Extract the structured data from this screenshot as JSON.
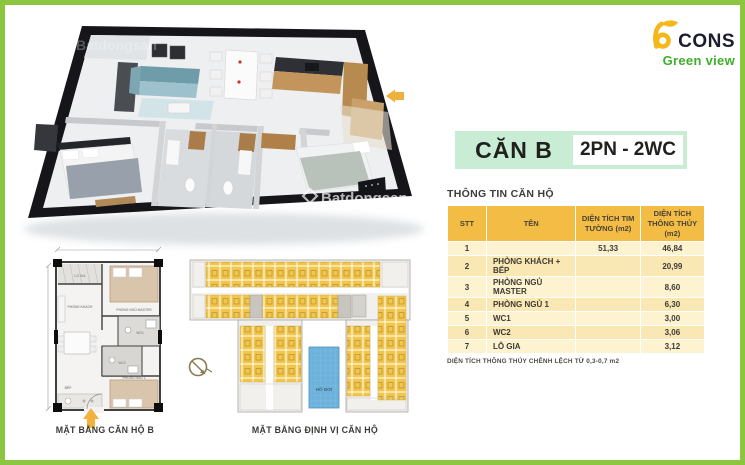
{
  "brand": {
    "name": "CONS",
    "subtitle": "Green view",
    "icon": "bcons-b-icon"
  },
  "unit_badge": {
    "name": "CĂN B",
    "config": "2PN - 2WC"
  },
  "info_table": {
    "title": "THÔNG TIN CĂN HỘ",
    "columns": [
      "STT",
      "TÊN",
      "DIỆN TÍCH TIM TƯỜNG (m2)",
      "DIỆN TÍCH THÔNG THỦY (m2)"
    ],
    "rows": [
      {
        "stt": "1",
        "ten": "",
        "tim_tuong": "51,33",
        "thong_thuy": "46,84"
      },
      {
        "stt": "2",
        "ten": "PHÒNG KHÁCH + BẾP",
        "tim_tuong": "",
        "thong_thuy": "20,99"
      },
      {
        "stt": "3",
        "ten": "PHÒNG NGỦ MASTER",
        "tim_tuong": "",
        "thong_thuy": "8,60"
      },
      {
        "stt": "4",
        "ten": "PHÒNG NGỦ 1",
        "tim_tuong": "",
        "thong_thuy": "6,30"
      },
      {
        "stt": "5",
        "ten": "WC1",
        "tim_tuong": "",
        "thong_thuy": "3,00"
      },
      {
        "stt": "6",
        "ten": "WC2",
        "tim_tuong": "",
        "thong_thuy": "3,06"
      },
      {
        "stt": "7",
        "ten": "LÔ GIA",
        "tim_tuong": "",
        "thong_thuy": "3,12"
      }
    ],
    "footnote": "DIỆN TÍCH THÔNG THỦY CHÊNH LỆCH TỪ 0,3-0,7 m2"
  },
  "plans": {
    "unit_plan_caption": "MẶT BẰNG CĂN HỘ B",
    "site_plan_caption": "MẶT BẰNG ĐỊNH VỊ CĂN HỘ",
    "pool_label": "HỒ BƠI",
    "rooms": {
      "logia": "LÔ GIA",
      "living": "PHÒNG KHÁCH",
      "kitchen": "BẾP",
      "master": "PHÒNG NGỦ MASTER",
      "bedroom1": "PHÒNG NGỦ 1",
      "wc1": "WC1",
      "wc2": "WC2"
    }
  },
  "watermark": {
    "text": "Batdongsan"
  },
  "colors": {
    "frame_green": "#8cc63e",
    "brand_green": "#3fae2a",
    "brand_yellow": "#f5b719",
    "brand_navy": "#1c1c30",
    "badge_mint": "#c9ecd5",
    "table_header": "#f3bc45",
    "row_light": "#fdf3d0",
    "row_dark": "#f9e8b4",
    "unit_highlight": "#f1c64b",
    "pool_blue": "#6db2dc",
    "arrow_orange": "#f3b13e"
  }
}
